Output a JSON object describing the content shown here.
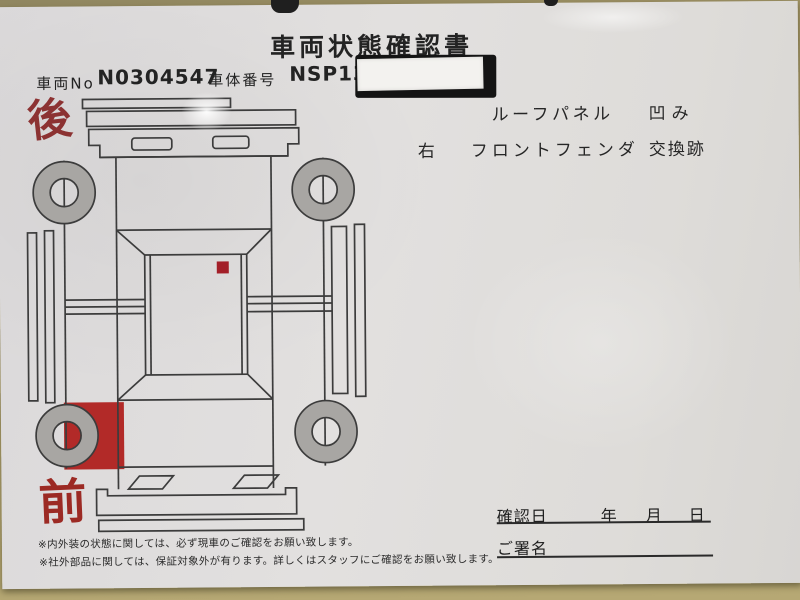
{
  "header": {
    "title": "車両状態確認書",
    "vehicle_no_label": "車両No",
    "vehicle_no_value": "N0304547",
    "chassis_no_label": "車体番号",
    "chassis_no_value": "NSP130-",
    "chassis_no_redacted_note": "white sticker covering rest of chassis number"
  },
  "damage_list": {
    "rows": [
      {
        "side": "",
        "part": "ルーフパネル",
        "condition": "凹み"
      },
      {
        "side": "右",
        "part": "フロントフェンダ",
        "condition": "交換跡"
      }
    ]
  },
  "diagram": {
    "rear_label": "後",
    "front_label": "前",
    "markers": [
      {
        "name": "roof-dent-marker",
        "color": "#a31f28"
      },
      {
        "name": "right-front-fender-replacement-marker",
        "color": "#b22a28"
      }
    ],
    "wheel_color": "#a8a6a3",
    "line_color": "#3c3c3c"
  },
  "confirmation": {
    "date_label": "確認日",
    "year_label": "年",
    "month_label": "月",
    "day_label": "日",
    "signature_label": "ご署名"
  },
  "footnotes": [
    "※内外装の状態に関しては、必ず現車のご確認をお願い致します。",
    "※社外部品に関しては、保証対象外が有ります。詳しくはスタッフにご確認をお願い致します。"
  ],
  "colors": {
    "desk": "#b2a46f",
    "paper": "#e0dedd",
    "rear_label_red": "#8c3232",
    "front_label_red": "#9c2a24",
    "sticker_black": "#141414",
    "sticker_white": "#f3f2ef"
  }
}
